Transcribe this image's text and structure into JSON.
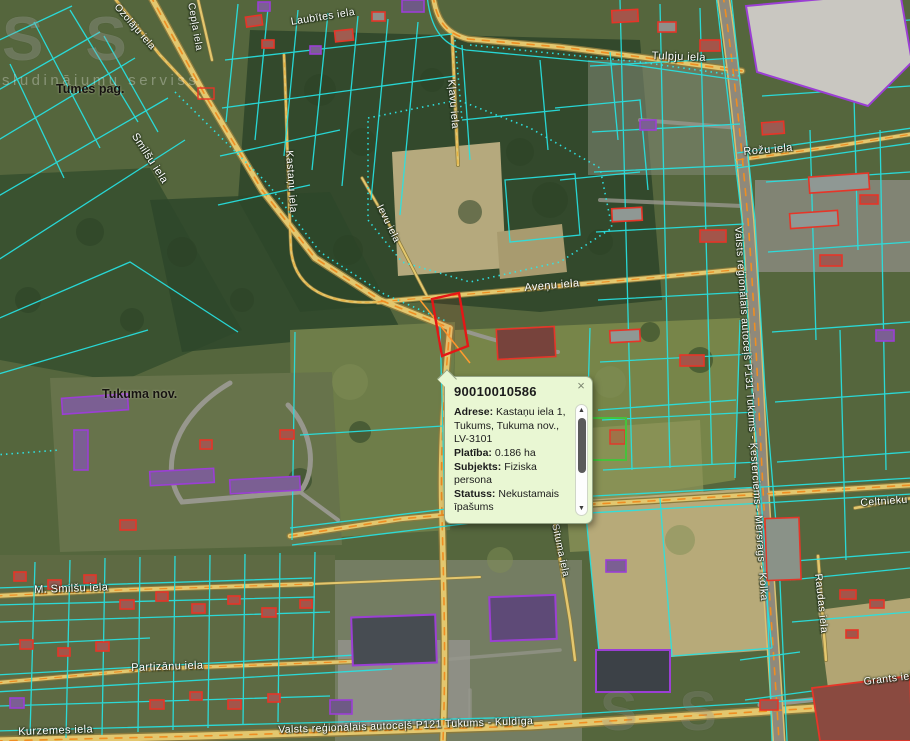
{
  "map": {
    "watermark": {
      "big": "SS",
      "tagline": "sludinājumu serviss"
    },
    "area_labels": [
      {
        "text": "Tumes pag.",
        "x": 56,
        "y": 82
      },
      {
        "text": "Tukuma nov.",
        "x": 102,
        "y": 387
      }
    ],
    "street_labels": [
      {
        "text": "Ozolāju iela",
        "x": 120,
        "y": 2,
        "rot": 49,
        "size": 10
      },
      {
        "text": "Cepļa iela",
        "x": 196,
        "y": 2,
        "rot": 80,
        "size": 10
      },
      {
        "text": "Laubītes iela",
        "x": 290,
        "y": 16,
        "rot": -9,
        "size": 10.5
      },
      {
        "text": "Tulpju iela",
        "x": 652,
        "y": 50,
        "rot": 2,
        "size": 11
      },
      {
        "text": "Kļavu iela",
        "x": 457,
        "y": 79,
        "rot": 85,
        "size": 10.5
      },
      {
        "text": "Rožu iela",
        "x": 743,
        "y": 146,
        "rot": -5,
        "size": 11
      },
      {
        "text": "Smilšu iela",
        "x": 139,
        "y": 131,
        "rot": 57,
        "size": 11
      },
      {
        "text": "Kastaņu iela",
        "x": 295,
        "y": 150,
        "rot": 86,
        "size": 10.5
      },
      {
        "text": "Ievu iela",
        "x": 384,
        "y": 203,
        "rot": 64,
        "size": 10
      },
      {
        "text": "Aveņu iela",
        "x": 524,
        "y": 282,
        "rot": -5,
        "size": 11
      },
      {
        "text": "Valsts reģionālais autoceļš P131 Tukums - Ķesterciems - Mērsrags - Kolka",
        "x": 744,
        "y": 226,
        "rot": 86,
        "size": 10.5
      },
      {
        "text": "Asteru iela",
        "x": 494,
        "y": 501,
        "rot": -4,
        "size": 11
      },
      {
        "text": "Celtnieku iela",
        "x": 860,
        "y": 497,
        "rot": -4,
        "size": 10.5
      },
      {
        "text": "Situma iela",
        "x": 560,
        "y": 523,
        "rot": 78,
        "size": 10
      },
      {
        "text": "Raudas iela",
        "x": 824,
        "y": 573,
        "rot": 84,
        "size": 10.5
      },
      {
        "text": "M. Smilšu iela",
        "x": 34,
        "y": 584,
        "rot": -2,
        "size": 11
      },
      {
        "text": "Partizānu iela",
        "x": 131,
        "y": 662,
        "rot": -2,
        "size": 11
      },
      {
        "text": "Grants iela",
        "x": 863,
        "y": 676,
        "rot": -7,
        "size": 10.5
      },
      {
        "text": "Kurzemes iela",
        "x": 18,
        "y": 726,
        "rot": -2,
        "size": 11
      },
      {
        "text": "Valsts reģionālais autoceļš P121 Tukums - Kuldīga",
        "x": 278,
        "y": 724,
        "rot": -2,
        "size": 10.5
      }
    ]
  },
  "popup": {
    "title": "90010010586",
    "close_glyph": "×",
    "scrollbar": {
      "up_glyph": "▲",
      "down_glyph": "▼"
    },
    "fields": [
      {
        "label": "Adrese:",
        "value": "Kastaņu iela 1, Tukums, Tukuma nov., LV-3101"
      },
      {
        "label": "Platība:",
        "value": "0.186 ha"
      },
      {
        "label": "Subjekts:",
        "value": "Fiziska persona"
      },
      {
        "label": "Statuss:",
        "value": "Nekustamais īpašums"
      }
    ]
  },
  "colors": {
    "parcel_line": "#27e3e3",
    "selected_parcel": "#e51616",
    "building_outline_red": "#e63528",
    "building_outline_purple": "#9b3fd4",
    "road_fill": "#e3c76e",
    "road_dash": "#ef8e22",
    "popup_bg": "#e9f7d3"
  }
}
